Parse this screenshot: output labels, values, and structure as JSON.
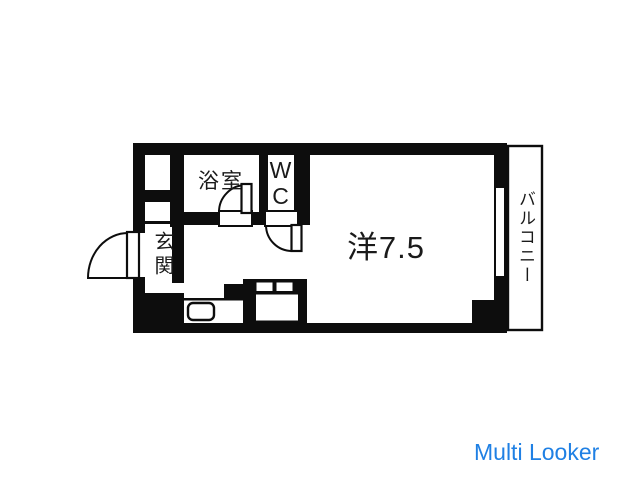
{
  "floorplan": {
    "labels": {
      "bathroom": "浴室",
      "toilet": "WC",
      "entrance": "玄関",
      "main_room": "洋7.5",
      "balcony": "バルコニー"
    },
    "colors": {
      "wall": "#0d0d0d",
      "background": "#ffffff",
      "text": "#1a1a1a"
    }
  },
  "watermark": {
    "text": "Multi Looker",
    "color": "#1f80e4"
  }
}
